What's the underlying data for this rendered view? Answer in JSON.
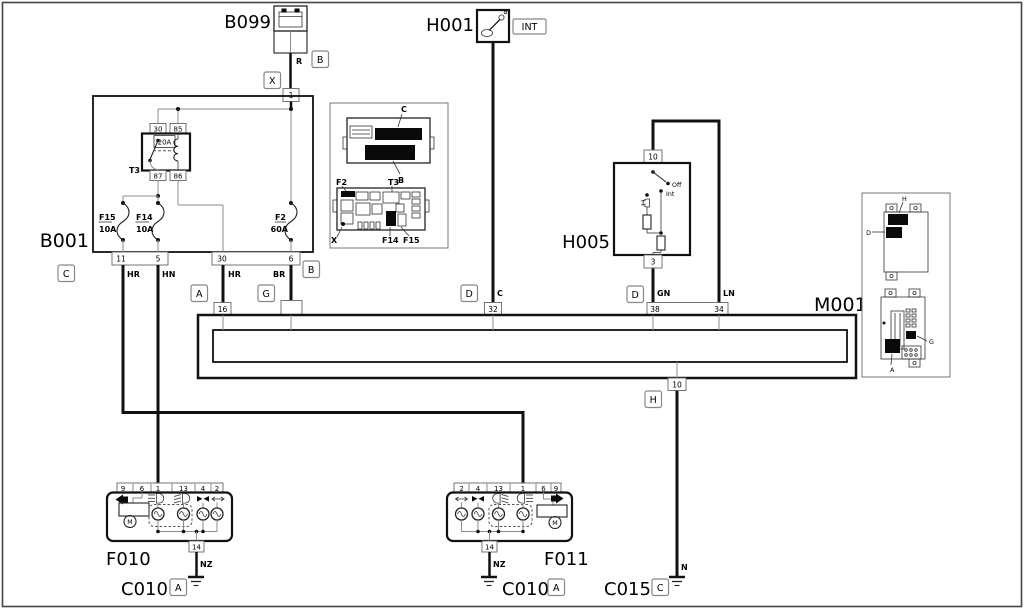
{
  "colors": {
    "line": "#111111",
    "gray": "#8c8c8c",
    "background": "#ffffff"
  },
  "b099": {
    "id": "B099",
    "wire_label": "R",
    "pin": "1",
    "connector_x": "X",
    "connector_b": "B"
  },
  "h001": {
    "id": "H001",
    "connector_int": "INT",
    "wire_label": "C"
  },
  "b001": {
    "id": "B001",
    "relay": {
      "id": "T3",
      "rating": "20A",
      "pin_30": "30",
      "pin_85": "85",
      "pin_87": "87",
      "pin_86": "86"
    },
    "fuse_f15": {
      "id": "F15",
      "rating": "10A"
    },
    "fuse_f14": {
      "id": "F14",
      "rating": "10A"
    },
    "fuse_f2": {
      "id": "F2",
      "rating": "60A"
    },
    "pin_11": "11",
    "pin_5": "5",
    "pin_30b": "30",
    "pin_6": "6",
    "connector_c": "C",
    "connector_b": "B",
    "wire_hr1": "HR",
    "wire_hn": "HN",
    "wire_hr2": "HR",
    "wire_br": "BR"
  },
  "inset_fusebox": {
    "label_c": "C",
    "label_b": "B",
    "label_f2": "F2",
    "label_t3": "T3",
    "label_x": "X",
    "label_f14": "F14",
    "label_f15": "F15"
  },
  "h005": {
    "id": "H005",
    "pin_10": "10",
    "pin_3": "3",
    "pos_off": "Off",
    "pos_int": "Int",
    "connector_d": "D",
    "wire_gn": "GN",
    "wire_ln": "LN"
  },
  "m001": {
    "id": "M001",
    "pin_16": "16",
    "pin_32": "32",
    "pin_38": "38",
    "pin_34": "34",
    "pin_10": "10",
    "conn_a": "A",
    "conn_g": "G",
    "conn_d": "D",
    "conn_h": "H"
  },
  "f010": {
    "id": "F010",
    "pins": [
      "9",
      "6",
      "1",
      "13",
      "4",
      "2"
    ],
    "pin_14": "14",
    "motor": "M",
    "wire_nz": "NZ"
  },
  "f011": {
    "id": "F011",
    "pins": [
      "2",
      "4",
      "13",
      "1",
      "6",
      "9"
    ],
    "pin_14": "14",
    "motor": "M",
    "wire_nz": "NZ"
  },
  "c010_left": {
    "id": "C010",
    "connector": "A"
  },
  "c010_right": {
    "id": "C010",
    "connector": "A"
  },
  "c015": {
    "id": "C015",
    "connector": "C",
    "wire_n": "N"
  },
  "inset_right": {
    "label_h": "H",
    "label_d": "D",
    "label_g": "G",
    "label_a": "A"
  }
}
